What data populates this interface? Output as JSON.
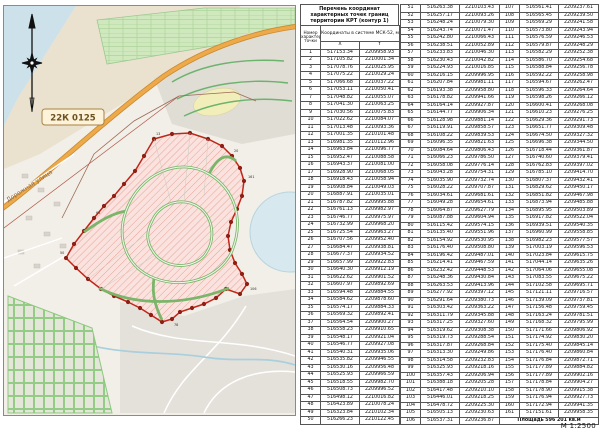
{
  "page": {
    "scale_label": "М 1:2500"
  },
  "map": {
    "road_ref_label": "22К 0125",
    "street_name": "Дорожная улица",
    "icons": {
      "compass": "compass-rose-icon"
    }
  },
  "tables": {
    "title_lines": [
      "Перечень координат",
      "характерных точек границ",
      "территории КРТ (контур 1)"
    ],
    "point_col_header": "Номер характерной точки",
    "coords_header": "Координаты в системе МСК-52, м",
    "x_label": "X",
    "y_label": "Y",
    "area_text": "Площадь 596 201 кв.м",
    "points": [
      [
        1,
        "517153.34",
        "2209958.93"
      ],
      [
        2,
        "517105.82",
        "2210001.34"
      ],
      [
        3,
        "517078.76",
        "2210025.95"
      ],
      [
        4,
        "517075.22",
        "2210029.24"
      ],
      [
        5,
        "517066.68",
        "2210037.22"
      ],
      [
        6,
        "517053.11",
        "2210050.41"
      ],
      [
        7,
        "517048.82",
        "2210055.07"
      ],
      [
        8,
        "517041.30",
        "2210063.25"
      ],
      [
        9,
        "517030.56",
        "2210075.83"
      ],
      [
        10,
        "517022.62",
        "2210084.07"
      ],
      [
        11,
        "517013.48",
        "2210093.36"
      ],
      [
        12,
        "517001.35",
        "2210101.48"
      ],
      [
        13,
        "516981.35",
        "2210112.96"
      ],
      [
        14,
        "516963.84",
        "2210096.77"
      ],
      [
        15,
        "516952.47",
        "2210088.58"
      ],
      [
        16,
        "516943.37",
        "2210081.00"
      ],
      [
        17,
        "516928.90",
        "2210068.05"
      ],
      [
        18,
        "516918.43",
        "2210058.94"
      ],
      [
        19,
        "516908.84",
        "2210049.03"
      ],
      [
        20,
        "516887.91",
        "2210035.01"
      ],
      [
        21,
        "516787.82",
        "2209995.88"
      ],
      [
        22,
        "516761.13",
        "2209982.97"
      ],
      [
        23,
        "516746.77",
        "2209975.97"
      ],
      [
        24,
        "516732.99",
        "2209968.20"
      ],
      [
        25,
        "516725.54",
        "2209963.27"
      ],
      [
        26,
        "516707.56",
        "2209952.40"
      ],
      [
        27,
        "516684.47",
        "2209938.81"
      ],
      [
        28,
        "516677.37",
        "2209934.52"
      ],
      [
        29,
        "516657.99",
        "2209922.83"
      ],
      [
        30,
        "516640.30",
        "2209912.19"
      ],
      [
        31,
        "516622.62",
        "2209901.52"
      ],
      [
        32,
        "516607.97",
        "2209892.69"
      ],
      [
        33,
        "516594.48",
        "2209884.55"
      ],
      [
        34,
        "516584.62",
        "2209878.60"
      ],
      [
        35,
        "516574.17",
        "2209884.33"
      ],
      [
        36,
        "516569.32",
        "2209892.41"
      ],
      [
        37,
        "516564.54",
        "2209900.27"
      ],
      [
        38,
        "516558.23",
        "2209910.65"
      ],
      [
        39,
        "516548.17",
        "2209921.04"
      ],
      [
        40,
        "516546.77",
        "2209927.08"
      ],
      [
        41,
        "516540.31",
        "2209935.06"
      ],
      [
        42,
        "516535.82",
        "2209946.55"
      ],
      [
        43,
        "516530.16",
        "2209956.48"
      ],
      [
        44,
        "516525.93",
        "2209966.59"
      ],
      [
        45,
        "516518.55",
        "2209982.70"
      ],
      [
        46,
        "516508.73",
        "2209996.52"
      ],
      [
        47,
        "516498.12",
        "2210016.82"
      ],
      [
        48,
        "516423.89",
        "2210078.24"
      ],
      [
        49,
        "516323.84",
        "2210102.34"
      ],
      [
        50,
        "516266.23",
        "2210122.45"
      ],
      [
        51,
        "516263.38",
        "2210103.43"
      ],
      [
        52,
        "516257.17",
        "2210093.26"
      ],
      [
        53,
        "516248.24",
        "2210079.30"
      ],
      [
        54,
        "516243.74",
        "2210071.47"
      ],
      [
        55,
        "516242.80",
        "2210066.43"
      ],
      [
        56,
        "516238.51",
        "2210052.89"
      ],
      [
        57,
        "516233.83",
        "2210046.30"
      ],
      [
        58,
        "516230.43",
        "2210042.82"
      ],
      [
        59,
        "516224.93",
        "2210016.85"
      ],
      [
        60,
        "516216.15",
        "2209996.95"
      ],
      [
        61,
        "516207.84",
        "2209981.11"
      ],
      [
        62,
        "516193.38",
        "2209958.80"
      ],
      [
        63,
        "516178.82",
        "2209941.66"
      ],
      [
        64,
        "516164.14",
        "2209927.87"
      ],
      [
        65,
        "516144.77",
        "2209906.34"
      ],
      [
        66,
        "516128.98",
        "2209881.14"
      ],
      [
        67,
        "516119.91",
        "2209858.57"
      ],
      [
        68,
        "516108.22",
        "2209839.53"
      ],
      [
        69,
        "516096.35",
        "2209821.63"
      ],
      [
        70,
        "516084.64",
        "2209806.43"
      ],
      [
        71,
        "516066.23",
        "2209786.50"
      ],
      [
        72,
        "516058.08",
        "2209776.14"
      ],
      [
        73,
        "516043.28",
        "2209754.31"
      ],
      [
        74,
        "516035.90",
        "2209732.74"
      ],
      [
        75,
        "516028.22",
        "2209707.87"
      ],
      [
        76,
        "516034.61",
        "2209681.61"
      ],
      [
        77,
        "516049.28",
        "2209654.61"
      ],
      [
        78,
        "516064.87",
        "2209627.79"
      ],
      [
        79,
        "516087.88",
        "2209604.94"
      ],
      [
        80,
        "516115.42",
        "2209574.15"
      ],
      [
        81,
        "516135.40",
        "2209551.96"
      ],
      [
        82,
        "516154.92",
        "2209530.95"
      ],
      [
        83,
        "516176.40",
        "2209508.80"
      ],
      [
        84,
        "516196.42",
        "2209487.01"
      ],
      [
        85,
        "516214.41",
        "2209467.59"
      ],
      [
        86,
        "516232.42",
        "2209448.53"
      ],
      [
        87,
        "516248.36",
        "2209430.84"
      ],
      [
        88,
        "516263.53",
        "2209413.96"
      ],
      [
        89,
        "516277.92",
        "2209397.12"
      ],
      [
        90,
        "516291.64",
        "2209380.73"
      ],
      [
        91,
        "516303.42",
        "2209363.22"
      ],
      [
        92,
        "516311.79",
        "2209345.88"
      ],
      [
        93,
        "516317.25",
        "2209327.60"
      ],
      [
        94,
        "516319.62",
        "2209308.38"
      ],
      [
        95,
        "516319.73",
        "2209288.54"
      ],
      [
        96,
        "516317.87",
        "2209268.84"
      ],
      [
        97,
        "516313.30",
        "2209249.86"
      ],
      [
        98,
        "516314.58",
        "2209232.83"
      ],
      [
        99,
        "516325.93",
        "2209218.16"
      ],
      [
        100,
        "516357.43",
        "2209206.94"
      ],
      [
        101,
        "516388.18",
        "2209205.28"
      ],
      [
        102,
        "516417.48",
        "2209210.10"
      ],
      [
        103,
        "516446.01",
        "2209218.25"
      ],
      [
        104,
        "516478.72",
        "2209225.30"
      ],
      [
        105,
        "516505.13",
        "2209230.63"
      ],
      [
        106,
        "516537.31",
        "2209236.87"
      ],
      [
        107,
        "516561.41",
        "2209237.61"
      ],
      [
        108,
        "516565.45",
        "2209239.50"
      ],
      [
        109,
        "516569.29",
        "2209241.58"
      ],
      [
        110,
        "516573.80",
        "2209243.94"
      ],
      [
        111,
        "516576.59",
        "2209246.53"
      ],
      [
        112,
        "516579.87",
        "2209248.29"
      ],
      [
        113,
        "516582.29",
        "2209252.38"
      ],
      [
        114,
        "516586.70",
        "2209254.68"
      ],
      [
        115,
        "516588.84",
        "2209256.78"
      ],
      [
        116,
        "516592.22",
        "2209258.98"
      ],
      [
        117,
        "516594.67",
        "2209262.47"
      ],
      [
        118,
        "516596.33",
        "2209264.64"
      ],
      [
        119,
        "516598.26",
        "2209266.12"
      ],
      [
        120,
        "516600.41",
        "2209268.08"
      ],
      [
        121,
        "516610.23",
        "2209276.25"
      ],
      [
        122,
        "516629.36",
        "2209291.73"
      ],
      [
        123,
        "516651.77",
        "2209309.48"
      ],
      [
        124,
        "516674.50",
        "2209327.32"
      ],
      [
        125,
        "516696.38",
        "2209344.50"
      ],
      [
        126,
        "516718.44",
        "2209361.87"
      ],
      [
        127,
        "516740.60",
        "2209379.41"
      ],
      [
        128,
        "516762.83",
        "2209397.02"
      ],
      [
        129,
        "516785.10",
        "2209414.70"
      ],
      [
        130,
        "516807.37",
        "2209432.41"
      ],
      [
        131,
        "516829.62",
        "2209450.17"
      ],
      [
        132,
        "516851.82",
        "2209467.98"
      ],
      [
        133,
        "516873.94",
        "2209485.88"
      ],
      [
        134,
        "516895.95",
        "2209503.89"
      ],
      [
        135,
        "516917.82",
        "2209522.04"
      ],
      [
        136,
        "516939.51",
        "2209540.35"
      ],
      [
        137,
        "516960.99",
        "2209558.85"
      ],
      [
        138,
        "516982.23",
        "2209577.57"
      ],
      [
        139,
        "517003.19",
        "2209596.53"
      ],
      [
        140,
        "517023.84",
        "2209615.75"
      ],
      [
        141,
        "517044.14",
        "2209635.26"
      ],
      [
        142,
        "517064.06",
        "2209655.08"
      ],
      [
        143,
        "517083.55",
        "2209675.22"
      ],
      [
        144,
        "517102.58",
        "2209695.71"
      ],
      [
        145,
        "517121.11",
        "2209716.57"
      ],
      [
        146,
        "517139.09",
        "2209737.81"
      ],
      [
        147,
        "517156.48",
        "2209759.45"
      ],
      [
        148,
        "517163.24",
        "2209781.51"
      ],
      [
        149,
        "517168.32",
        "2209795.99"
      ],
      [
        150,
        "517171.66",
        "2209806.92"
      ],
      [
        151,
        "517174.92",
        "2209830.20"
      ],
      [
        152,
        "517175.40",
        "2209845.14"
      ],
      [
        153,
        "517176.40",
        "2209860.84"
      ],
      [
        154,
        "517176.84",
        "2209872.71"
      ],
      [
        155,
        "517177.89",
        "2209884.82"
      ],
      [
        156,
        "517177.89",
        "2209902.16"
      ],
      [
        157,
        "517178.84",
        "2209904.27"
      ],
      [
        158,
        "517178.90",
        "2209915.38"
      ],
      [
        159,
        "517176.94",
        "2209927.73"
      ],
      [
        160,
        "517172.94",
        "2209941.35"
      ],
      [
        161,
        "517151.61",
        "2209958.35"
      ]
    ],
    "splits": [
      50,
      106
    ]
  }
}
